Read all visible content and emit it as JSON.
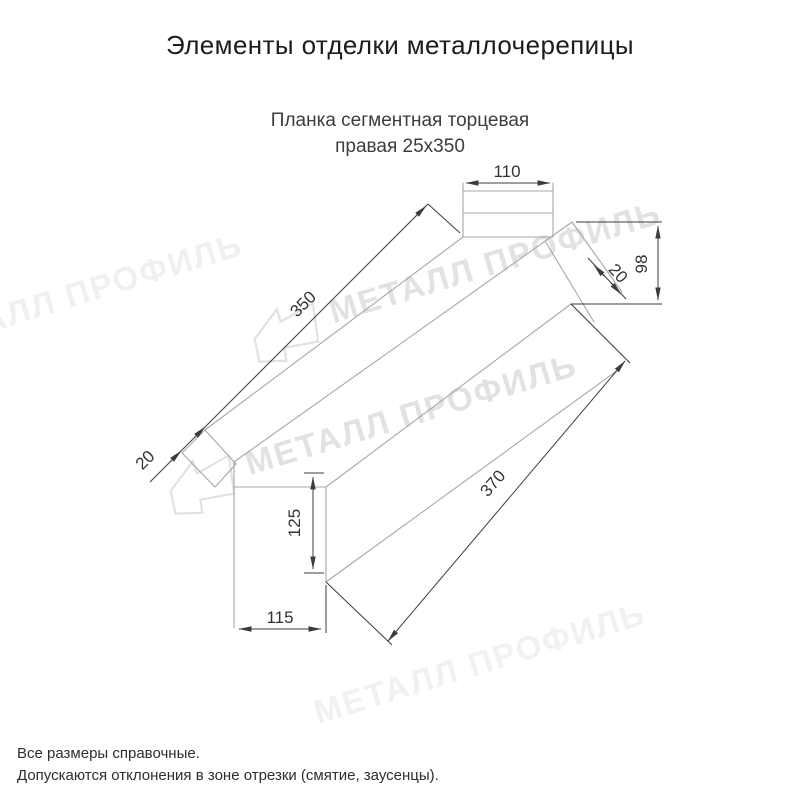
{
  "header": {
    "title": "Элементы отделки металлочерепицы"
  },
  "product": {
    "name_line1": "Планка сегментная торцевая",
    "name_line2": "правая 25x350"
  },
  "drawing": {
    "type": "technical-dimension-drawing",
    "dims": {
      "top_flange_width": "110",
      "length_top": "350",
      "hem_left": "20",
      "hem_right": "20",
      "end_height": "98",
      "length_bottom": "370",
      "tab_height": "125",
      "tab_width": "115"
    },
    "colors": {
      "outline": "#a7a7a7",
      "dimension": "#3c3c3c",
      "label": "#333333"
    }
  },
  "watermark": {
    "text": "МЕТАЛЛ ПРОФИЛЬ",
    "color": "#e2e2e2"
  },
  "footer": {
    "note1": "Все размеры справочные.",
    "note2": "Допускаются отклонения в зоне отрезки (смятие, заусенцы)."
  }
}
